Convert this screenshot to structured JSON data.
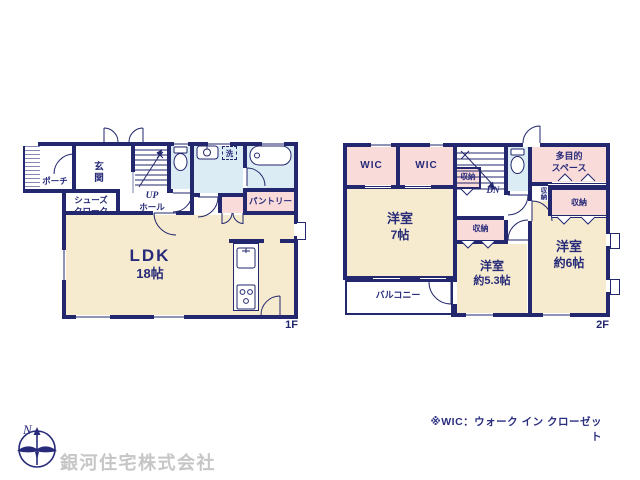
{
  "colors": {
    "wall": "#23276e",
    "label_text": "#272b79",
    "room_beige": "#f6ebce",
    "room_pink": "#f9dbda",
    "room_wet_blue": "#dcecf4",
    "watermark_gray": "#c6c6c6"
  },
  "floor1": {
    "floor_label": "1F",
    "porch": "ポーチ",
    "entrance": "玄関",
    "shoes_closet": "シューズクローク",
    "stairs_up": "UP",
    "stairs_hall": "ホール",
    "laundry": "洗",
    "pantry": "パントリー",
    "ldk": "LDK",
    "ldk_size": "18帖"
  },
  "floor2": {
    "floor_label": "2F",
    "wic_left": "WIC",
    "wic_right": "WIC",
    "storage_by_stairs": "収納",
    "stairs_down": "DN",
    "multipurpose_line1": "多目的",
    "multipurpose_line2": "スペース",
    "storage_cell": "収納",
    "storage_right": "収納",
    "storage_mid": "収納",
    "room7": "洋室",
    "room7_size": "7帖",
    "room53": "洋室",
    "room53_size": "約5.3帖",
    "room6": "洋室",
    "room6_size": "約6帖",
    "balcony": "バルコニー"
  },
  "footer": {
    "wic_note": "※WIC：ウォーク イン クローゼット",
    "company": "銀河住宅株式会社",
    "compass_north": "N"
  }
}
